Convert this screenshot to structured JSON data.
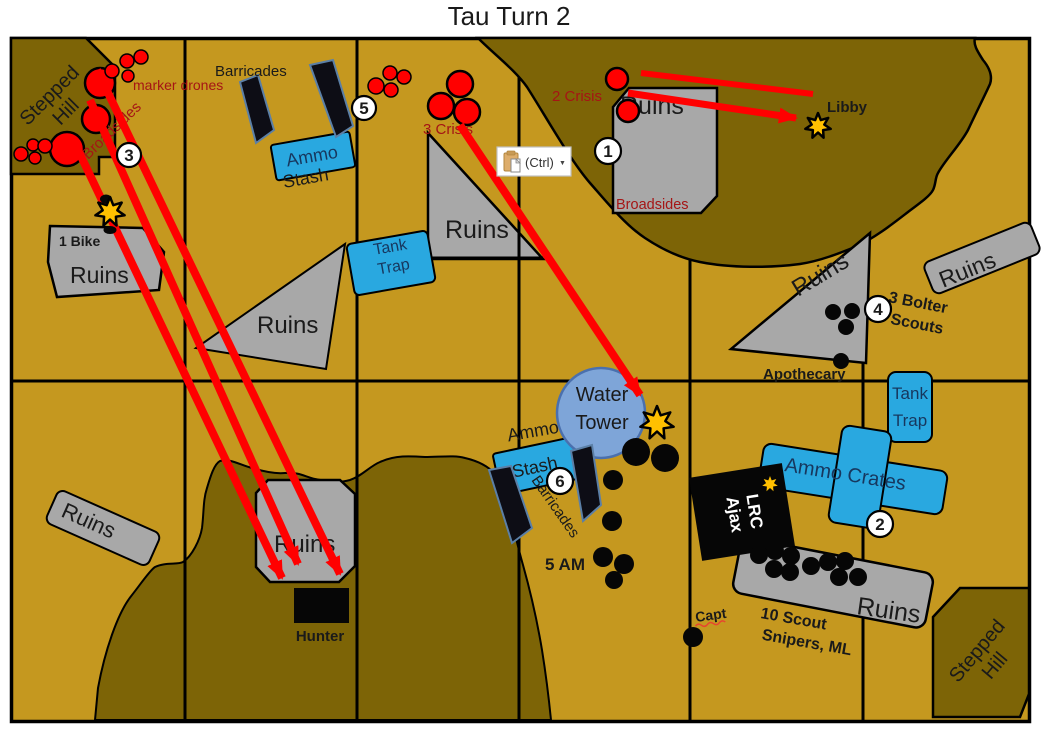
{
  "title": "Tau Turn 2",
  "paste": {
    "label": "(Ctrl)",
    "caret": "▼"
  },
  "badges": {
    "b1": "1",
    "b2": "2",
    "b3": "3",
    "b4": "4",
    "b5": "5",
    "b6": "6"
  },
  "labels": {
    "ruins": "Ruins",
    "stepped": "Stepped",
    "hill": "Hill",
    "marker_drones": "marker drones",
    "broadsides": "Broadsides",
    "barricades": "Barricades",
    "ammo": "Ammo",
    "stash": "Stash",
    "tank": "Tank",
    "trap": "Trap",
    "water": "Water",
    "tower": "Tower",
    "crisis2": "2 Crisis",
    "crisis3": "3 Crisis",
    "libby": "Libby",
    "bike": "1 Bike",
    "hunter": "Hunter",
    "ammo_crates": "Ammo Crates",
    "lrc": "LRC",
    "ajax": "Ajax",
    "scout10a": "10 Scout",
    "scout10b": "Snipers, ML",
    "bolter_a": "3 Bolter",
    "bolter_b": "Scouts",
    "apothecary": "Apothecary",
    "capt": "Capt",
    "am5": "5 AM"
  },
  "colors": {
    "gold": "#C5981F",
    "hill": "#7D6406",
    "gray": "#A8A8A8",
    "blue": "#29A8E0",
    "water": "#7EA5D8",
    "red": "#FF0000",
    "darkred": "#A51515",
    "navy": "#17375E",
    "star": "#FFC000"
  }
}
